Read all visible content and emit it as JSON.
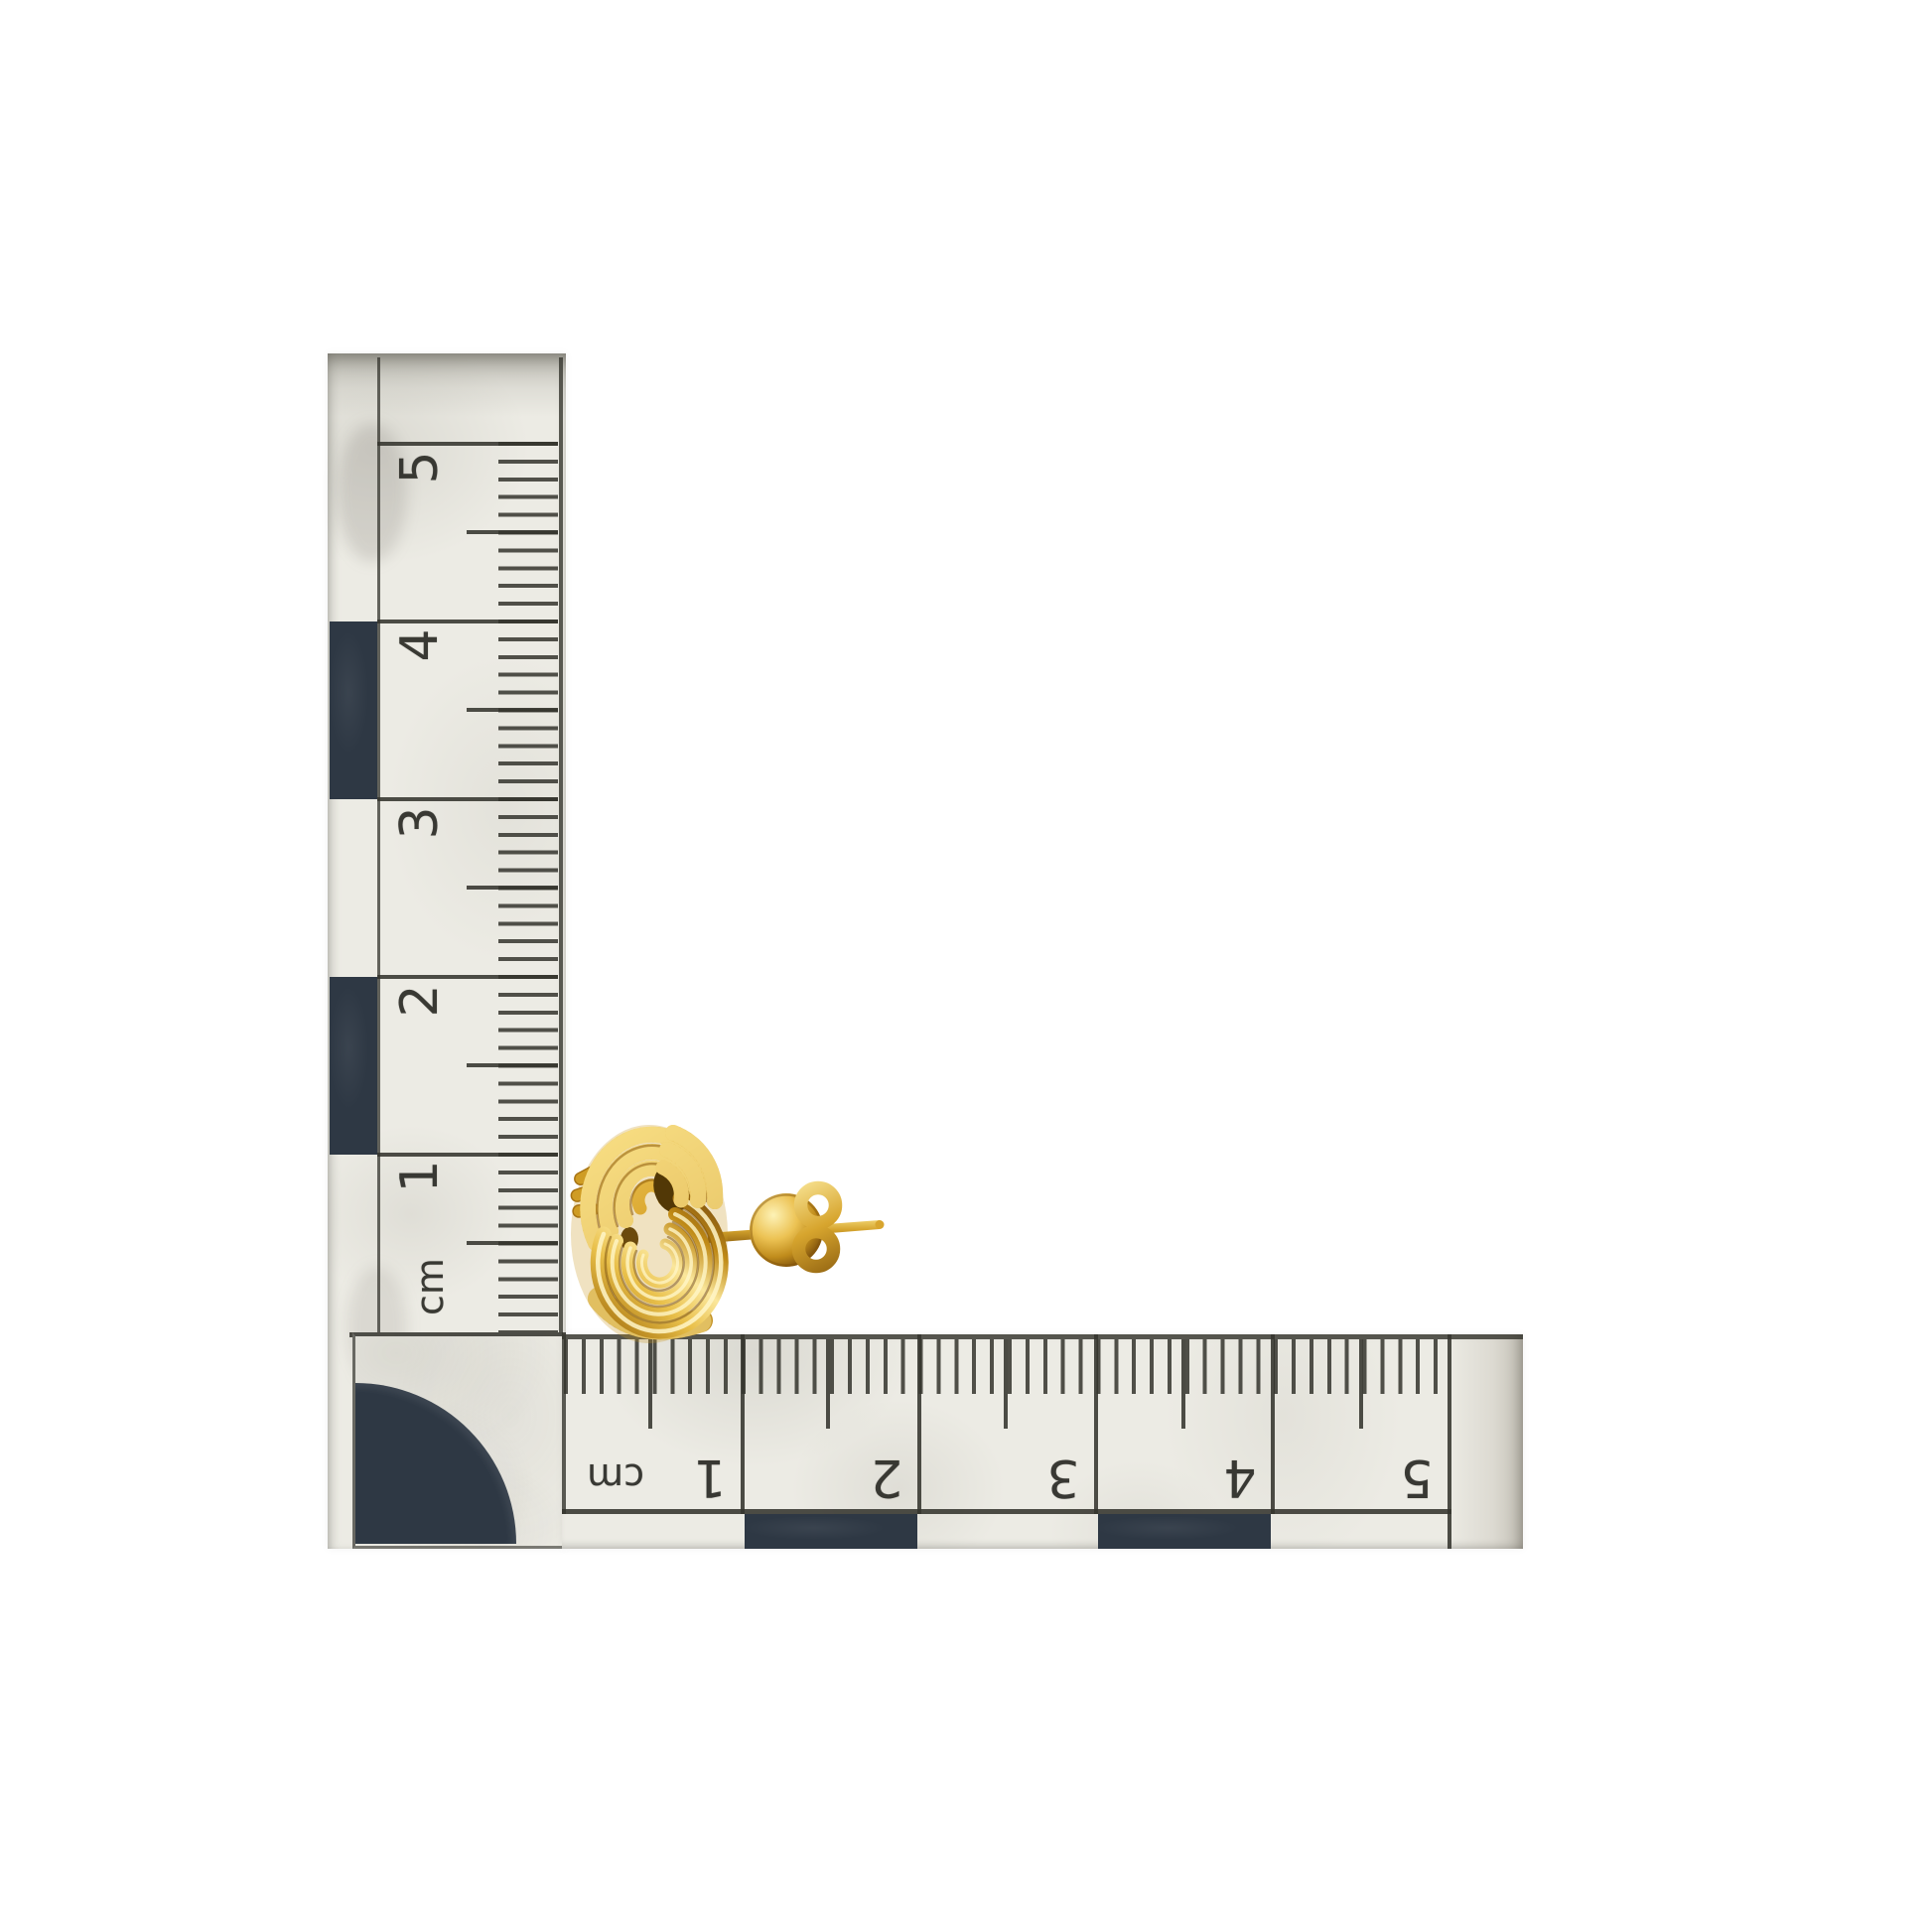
{
  "subject": {
    "description": "Yellow gold love-knot stud earring with straight post and butterfly back, photographed beside an L-shaped centimetre photo scale"
  },
  "rulers": {
    "vertical": {
      "unit_label": "cm",
      "labels": [
        "5",
        "4",
        "3",
        "2",
        "1"
      ]
    },
    "horizontal": {
      "unit_label": "cm",
      "labels": [
        "1",
        "2",
        "3",
        "4",
        "5"
      ]
    }
  },
  "colors": {
    "background": "#ffffff",
    "paper": "#ecebe4",
    "ink": "#34342d",
    "checker_navy": "#2e3844",
    "gold": "#d8a42d",
    "gold_light": "#fbe79c",
    "gold_dark": "#8a5c10"
  }
}
